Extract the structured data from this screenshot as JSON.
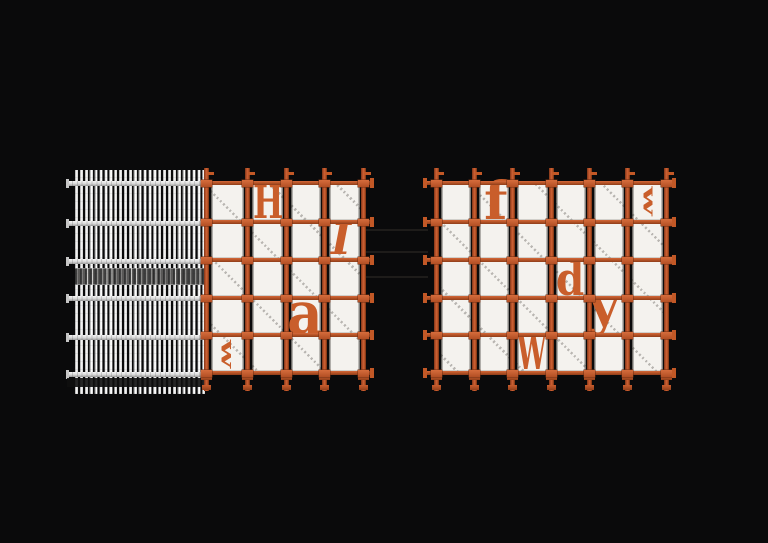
{
  "meta": {
    "description": "Dark 3D render of two orange scaffolding frame assemblies with white infill panels; scattered orange stencil letters on the panels; left assembly fronted by a dense white vertical-bar grate",
    "background_color": "#0a0a0b"
  },
  "colors": {
    "background": "#0a0a0b",
    "scaffold_orange": "#b6512a",
    "scaffold_orange_light": "#cd6234",
    "scaffold_orange_dark": "#7e3617",
    "panel_white": "#f4f2ee",
    "fence_bar_white": "#e9e9e9",
    "letter_orange": "#c95e2b"
  },
  "fence": {
    "x": 75,
    "y": 170,
    "w": 132,
    "h": 224,
    "bar_period": 4.89,
    "rail_ys": [
      181,
      221,
      259,
      296,
      335,
      372
    ],
    "rail_x": 67,
    "rail_w": 140,
    "rail_h": 5,
    "coupler_band": {
      "y": 268,
      "h": 15
    },
    "bottom_band": {
      "y": 378,
      "h": 9
    }
  },
  "grids": [
    {
      "name": "left-scaffold",
      "post_xs": [
        204,
        245,
        284,
        322,
        361
      ],
      "post_w": 5,
      "post_top": 168,
      "post_bottom": 391,
      "rail_ys": [
        181,
        220,
        258,
        296,
        333,
        371
      ],
      "rail_h": 4,
      "rail_x1": 202,
      "rail_x2": 371,
      "end_tabs": [
        "right"
      ],
      "letters": [
        {
          "ch": "H",
          "x": 253,
          "y": 179,
          "font": 46,
          "sx": 0.7
        },
        {
          "ch": "I",
          "x": 331,
          "y": 219,
          "font": 43,
          "italic": true
        },
        {
          "ch": "a",
          "x": 287,
          "y": 284,
          "font": 60,
          "sx": 0.92
        },
        {
          "ch": "w",
          "cx": 228,
          "cy": 354,
          "font": 33,
          "rot": 90,
          "sq": 0.55
        }
      ]
    },
    {
      "name": "right-scaffold",
      "post_xs": [
        434,
        472,
        510,
        549,
        587,
        625,
        664
      ],
      "post_w": 5,
      "post_top": 168,
      "post_bottom": 391,
      "rail_ys": [
        181,
        220,
        258,
        296,
        333,
        371
      ],
      "rail_h": 4,
      "rail_x1": 425,
      "rail_x2": 673,
      "end_tabs": [
        "left",
        "right"
      ],
      "letters": [
        {
          "ch": "f",
          "x": 484,
          "y": 176,
          "font": 52,
          "sx": 1.05
        },
        {
          "ch": "w",
          "cx": 649,
          "cy": 201,
          "font": 34,
          "rot": 90,
          "sq": 0.5
        },
        {
          "ch": "d",
          "x": 556,
          "y": 256,
          "font": 46,
          "sx": 0.88
        },
        {
          "ch": "y",
          "x": 589,
          "y": 281,
          "font": 52,
          "sx": 1.0
        },
        {
          "ch": "W",
          "x": 517,
          "y": 329,
          "font": 48,
          "sx": 0.55
        }
      ]
    }
  ],
  "ghost_lines": [
    {
      "x": 366,
      "y": 229,
      "w": 62,
      "h": 2
    },
    {
      "x": 366,
      "y": 251,
      "w": 62,
      "h": 2
    },
    {
      "x": 366,
      "y": 276,
      "w": 62,
      "h": 2
    }
  ]
}
